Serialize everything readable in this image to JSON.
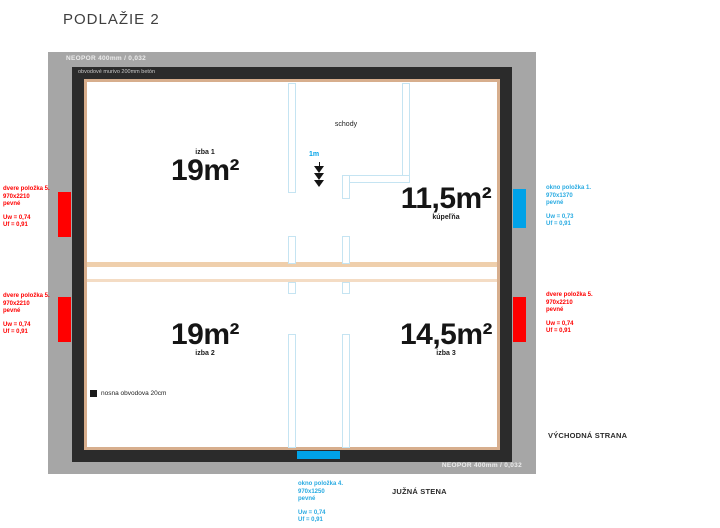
{
  "title": "PODLAŽIE 2",
  "frame": {
    "neopor_top": "NEOPOR 400mm / 0,032",
    "neopor_bottom": "NEOPOR 400mm / 0,032",
    "wall_note": "obvodové murivo 200mm betón"
  },
  "rooms": {
    "izba1": {
      "label": "izba 1",
      "area": "19m²"
    },
    "kupelna": {
      "label": "kúpeľňa",
      "area": "11,5m²"
    },
    "izba2": {
      "label": "izba 2",
      "area": "19m²"
    },
    "izba3": {
      "label": "izba 3",
      "area": "14,5m²"
    },
    "schody": {
      "label": "schody"
    }
  },
  "scale": {
    "label": "1m"
  },
  "legend": {
    "label": "nosna obvodova 20cm"
  },
  "annotations": {
    "door_left_top": {
      "title": "dvere položka 5.",
      "size": "970x2210",
      "mount": "pevné",
      "uw": "Uw = 0,74",
      "uf": "Uf = 0,91"
    },
    "door_left_bottom": {
      "title": "dvere položka 5.",
      "size": "970x2210",
      "mount": "pevné",
      "uw": "Uw = 0,74",
      "uf": "Uf = 0,91"
    },
    "window_right_top": {
      "title": "okno položka 1.",
      "size": "970x1370",
      "mount": "pevné",
      "uw": "Uw = 0,73",
      "uf": "Uf = 0,91"
    },
    "door_right": {
      "title": "dvere položka 5.",
      "size": "970x2210",
      "mount": "pevné",
      "uw": "Uw = 0,74",
      "uf": "Uf = 0,91"
    },
    "window_bottom": {
      "title": "okno položka 4.",
      "size": "970x1250",
      "mount": "pevné",
      "uw": "Uw = 0,74",
      "uf": "Uf = 0,91"
    }
  },
  "orientation": {
    "east": "VÝCHODNÁ STRANA",
    "south": "JUŽNÁ STENA"
  },
  "colors": {
    "door_marker": "#FF0000",
    "window_marker": "#00A2E8",
    "insulation_band": "#A6A6A6",
    "load_wall": "#2B2B2B",
    "wall_liner": "#D7AE8D",
    "partition_line": "#C5E4F2",
    "annotation_red": "#FF0000",
    "annotation_blue": "#29ABE2"
  }
}
